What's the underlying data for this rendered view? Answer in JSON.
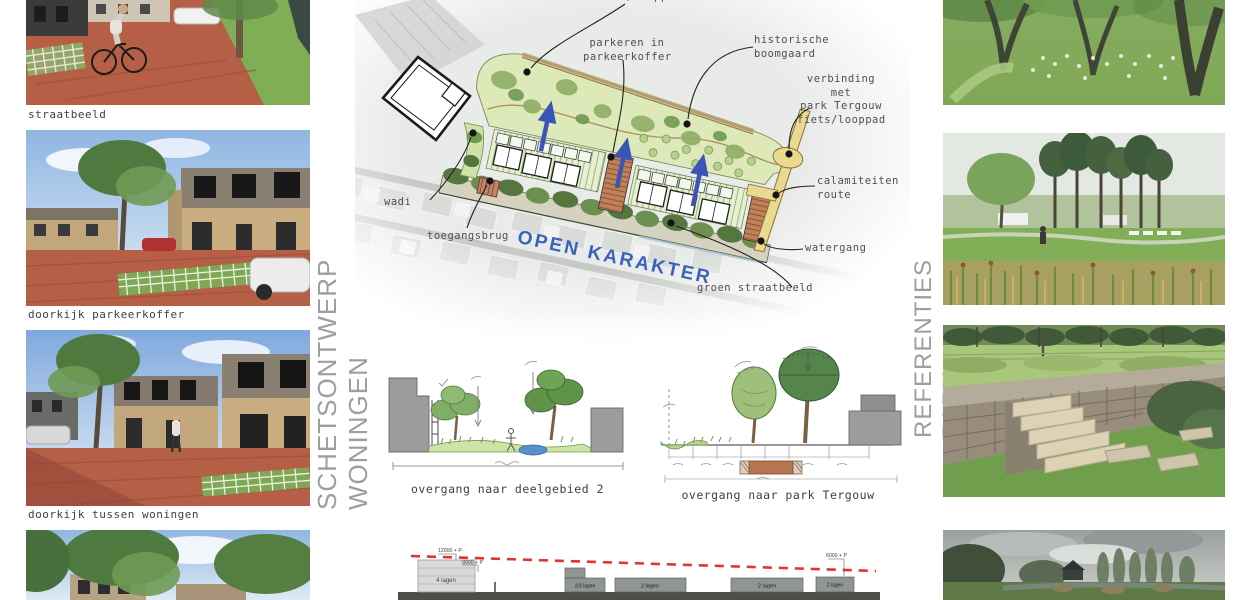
{
  "board": {
    "title_left": "SCHETSONTWERP WONINGEN",
    "title_right": "REFERENTIES PARK"
  },
  "left_column": {
    "captions": [
      "straatbeeld",
      "doorkijk parkeerkoffer",
      "doorkijk tussen woningen"
    ]
  },
  "map": {
    "annotations": {
      "fiets_looppad": "fiets/looppad",
      "parkeren": "parkeren in\nparkeerkoffer",
      "historische": "historische\nboomgaard",
      "verbinding": "verbinding met\npark Tergouw\nfiets/looppad",
      "calamiteiten": "calamiteiten\nroute",
      "watergang": "watergang",
      "groen_straatbeeld": "groen straatbeeld",
      "wadi": "wadi",
      "toegangsbrug": "toegangsbrug",
      "open_karakter": "OPEN KARAKTER"
    }
  },
  "sections": {
    "left_caption": "overgang naar deelgebied 2",
    "right_caption": "overgang naar park Tergouw"
  },
  "elevation": {
    "labels": {
      "h12000": "12000 + P",
      "h9000": "9000 + P",
      "h6000": "6000 + P"
    },
    "buildings": [
      "4 lagen",
      "2/3 lagen",
      "2 lagen",
      "2 lagen",
      "2 lagen"
    ]
  },
  "colors": {
    "accent_blue": "#3a62bc",
    "arrow_blue": "#3a55b5",
    "red_dash": "#e03434",
    "title_grey": "#9aa0a0",
    "caption_grey": "#3f3f3f"
  }
}
